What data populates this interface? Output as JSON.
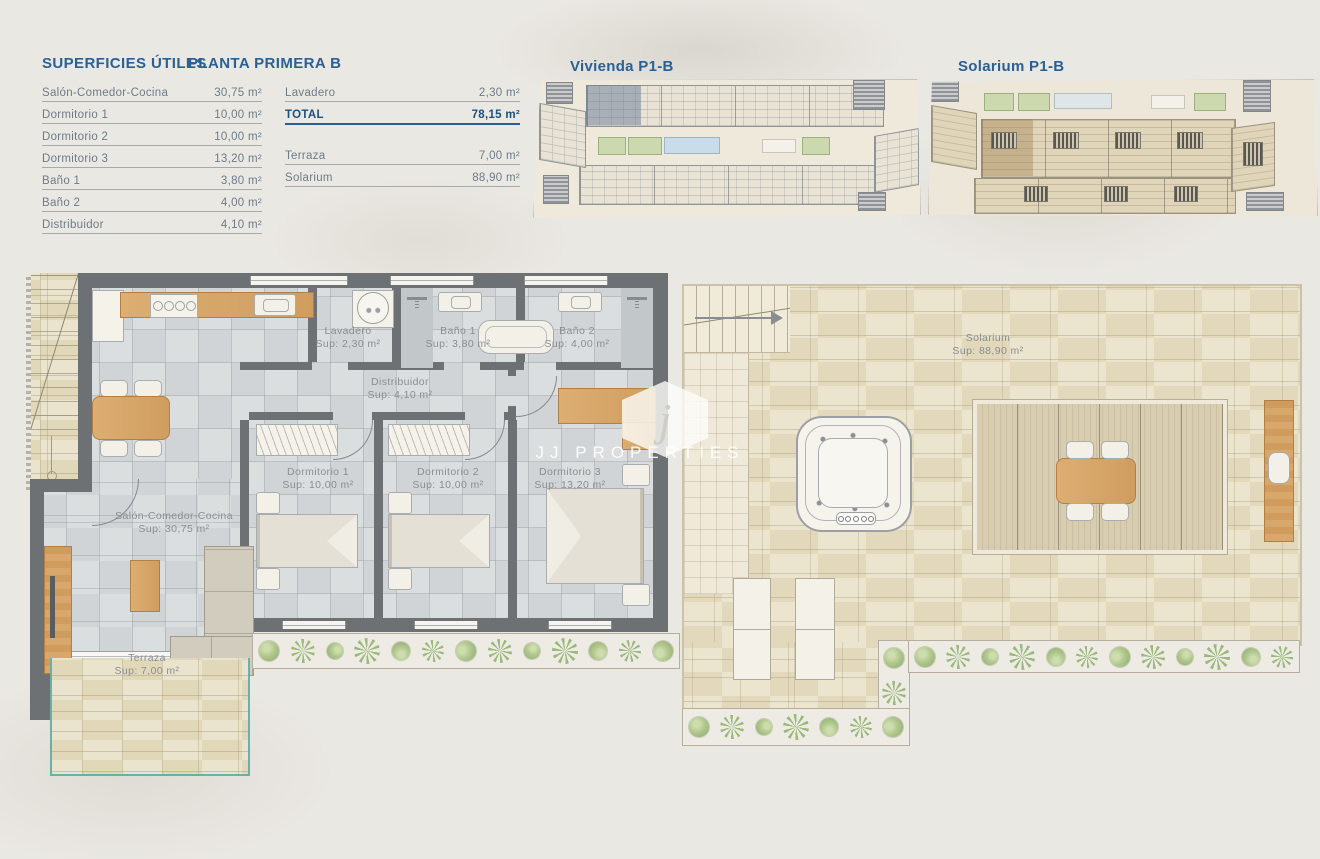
{
  "surfaces": {
    "title": "SUPERFICIES ÚTILES",
    "plan_name": "PLANTA PRIMERA B",
    "left_rows": [
      {
        "label": "Salón-Comedor-Cocina",
        "value": "30,75 m²"
      },
      {
        "label": "Dormitorio 1",
        "value": "10,00 m²"
      },
      {
        "label": "Dormitorio 2",
        "value": "10,00 m²"
      },
      {
        "label": "Dormitorio 3",
        "value": "13,20 m²"
      },
      {
        "label": "Baño 1",
        "value": "3,80 m²"
      },
      {
        "label": "Baño 2",
        "value": "4,00 m²"
      },
      {
        "label": "Distribuidor",
        "value": "4,10 m²"
      }
    ],
    "lavadero_row": {
      "label": "Lavadero",
      "value": "2,30 m²"
    },
    "total_row": {
      "label": "TOTAL",
      "value": "78,15 m²"
    },
    "terraza_row": {
      "label": "Terraza",
      "value": "7,00 m²"
    },
    "solarium_row": {
      "label": "Solarium",
      "value": "88,90 m²"
    }
  },
  "mini_plans": {
    "vivienda_title": "Vivienda P1-B",
    "solarium_title": "Solarium P1-B"
  },
  "rooms": {
    "lavadero": {
      "name": "Lavadero",
      "sup": "Sup: 2,30 m²"
    },
    "bano1": {
      "name": "Baño 1",
      "sup": "Sup: 3,80 m²"
    },
    "bano2": {
      "name": "Baño 2",
      "sup": "Sup: 4,00 m²"
    },
    "distribuidor": {
      "name": "Distribuidor",
      "sup": "Sup: 4,10 m²"
    },
    "dormitorio1": {
      "name": "Dormitorio 1",
      "sup": "Sup: 10,00 m²"
    },
    "dormitorio2": {
      "name": "Dormitorio 2",
      "sup": "Sup: 10,00 m²"
    },
    "dormitorio3": {
      "name": "Dormitorio 3",
      "sup": "Sup: 13,20 m²"
    },
    "salon": {
      "name": "Salón-Comedor-Cocina",
      "sup": "Sup: 30,75 m²"
    },
    "terraza": {
      "name": "Terraza",
      "sup": "Sup: 7,00 m²"
    },
    "solarium": {
      "name": "Solarium",
      "sup": "Sup: 88,90 m²"
    }
  },
  "watermark": {
    "initial": "j",
    "brand": "JJ PROPERTIES"
  },
  "colors": {
    "accent_blue": "#2a6094",
    "total_blue": "#1d4f7f",
    "wall_gray": "#6e7173",
    "wood": "#d7a469",
    "stone": "#e7dfc6",
    "glass_teal": "#56a8a2",
    "plant_green": "#a8bf85"
  }
}
